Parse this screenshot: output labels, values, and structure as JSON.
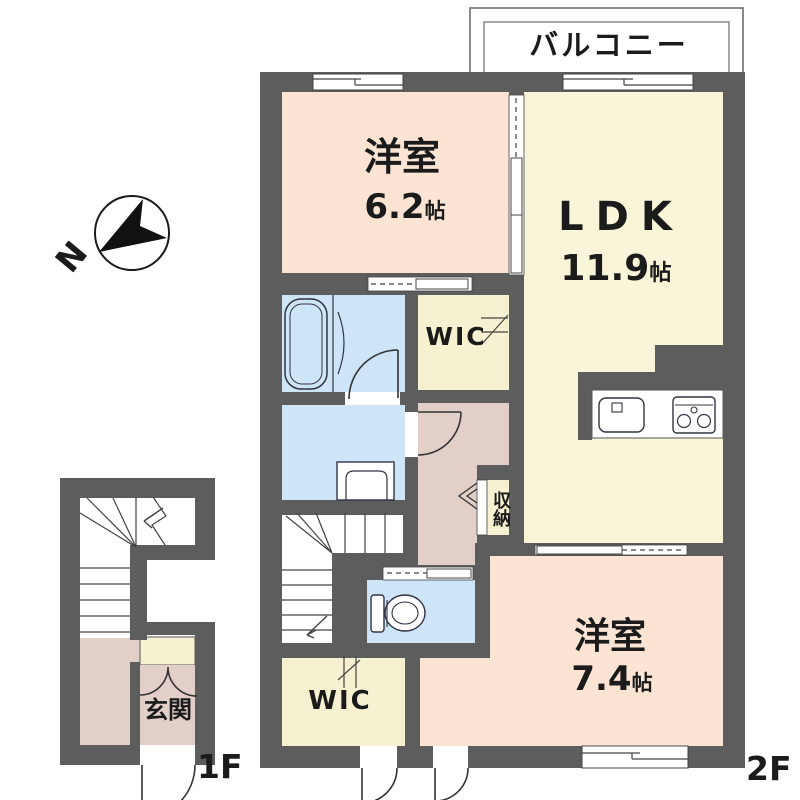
{
  "plan": {
    "compass_label": "N",
    "balcony_label": "バルコニー",
    "floor_markers": {
      "first": "1F",
      "second": "2F"
    },
    "rooms": {
      "bedroom_upper": {
        "name": "洋室",
        "size": "6.2",
        "unit": "帖"
      },
      "ldk": {
        "name": "LDK",
        "size": "11.9",
        "unit": "帖"
      },
      "bedroom_lower": {
        "name": "洋室",
        "size": "7.4",
        "unit": "帖"
      },
      "wic_upper": {
        "label": "WIC"
      },
      "wic_lower": {
        "label": "WIC"
      },
      "storage": {
        "label": "収納"
      },
      "entrance": {
        "label": "玄関"
      }
    },
    "colors": {
      "wall": "#5d5d5d",
      "bedroom_pink": "#fbe4d4",
      "ldk_cream": "#f8f5d8",
      "closet_cream": "#f6f1d0",
      "wet_area_blue": "#cde5f6",
      "hall_mauve": "#e2cfc8",
      "fixture_line": "#333333"
    }
  }
}
